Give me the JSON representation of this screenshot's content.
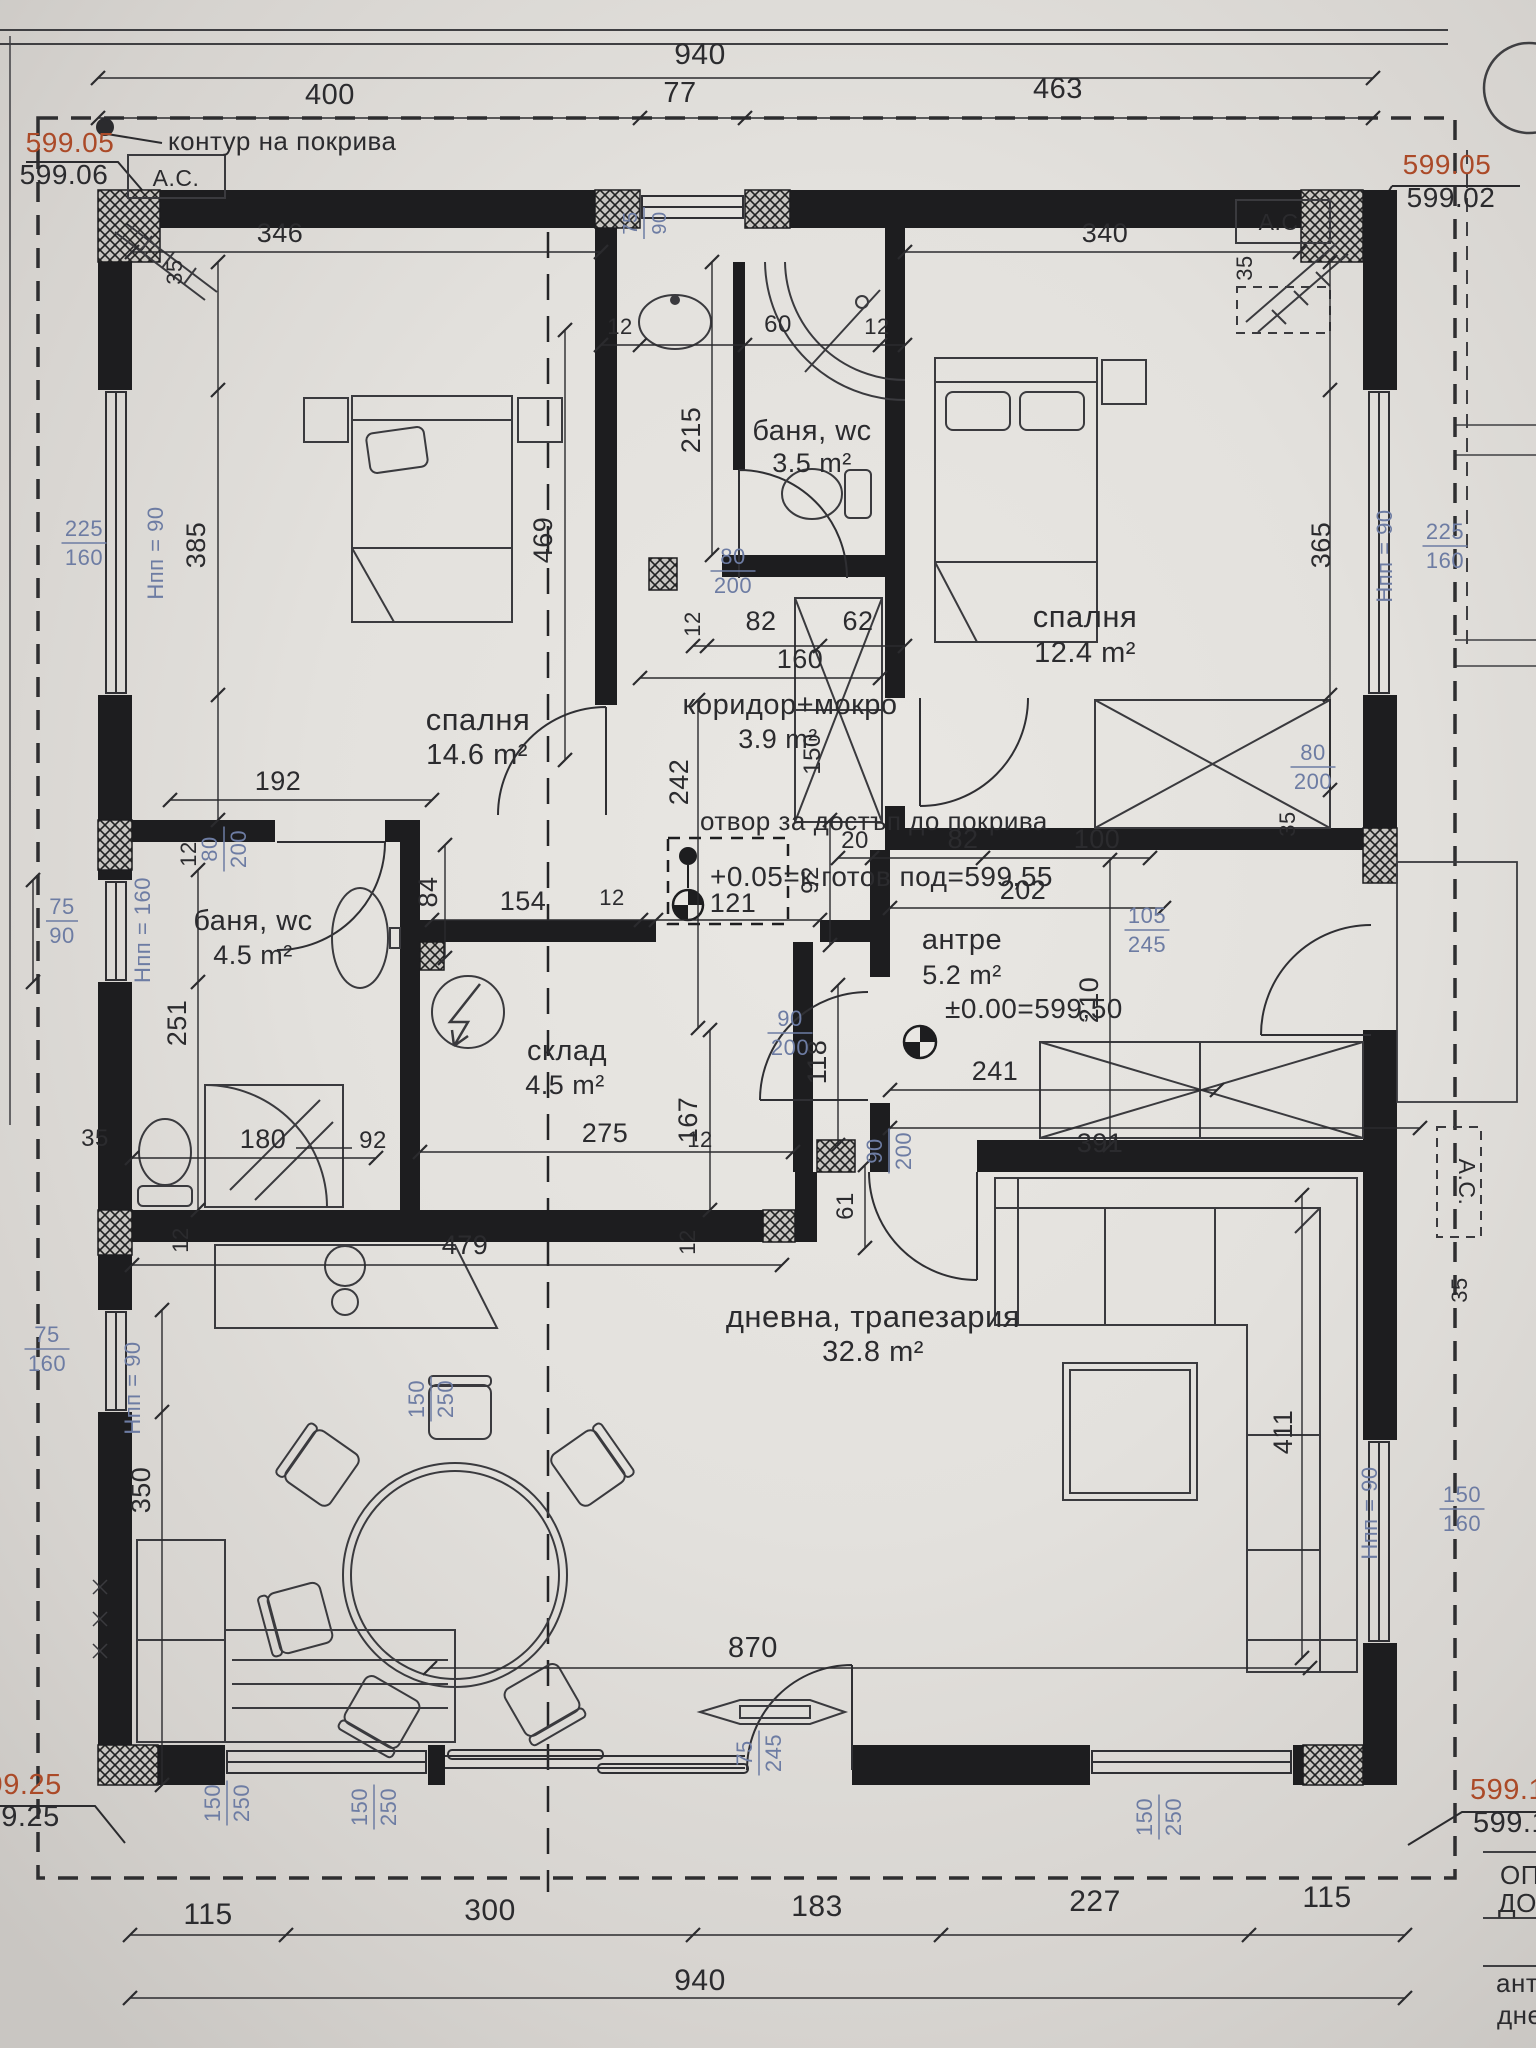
{
  "document": {
    "kind": "architectural floor plan",
    "language": "bulgarian"
  },
  "palette": {
    "ink": "#2b2b2e",
    "wall": "#1d1d1f",
    "blue": "#6d7ca3",
    "red": "#ab4a28",
    "paper": "#e6e4e0"
  },
  "labels": [
    {
      "n": "room-bedroom1-name",
      "t": "спалня",
      "x": 478,
      "y": 730,
      "s": 31
    },
    {
      "n": "room-bedroom1-area",
      "t": "14.6 m²",
      "x": 477,
      "y": 764,
      "s": 29
    },
    {
      "n": "room-bath1-name",
      "t": "баня, wc",
      "x": 812,
      "y": 440,
      "s": 29
    },
    {
      "n": "room-bath1-area",
      "t": "3.5 m²",
      "x": 812,
      "y": 472,
      "s": 27
    },
    {
      "n": "room-bedroom2-name",
      "t": "спалня",
      "x": 1085,
      "y": 627,
      "s": 31
    },
    {
      "n": "room-bedroom2-area",
      "t": "12.4 m²",
      "x": 1085,
      "y": 662,
      "s": 29
    },
    {
      "n": "room-corridor-name",
      "t": "коридор+мокро",
      "x": 790,
      "y": 714,
      "s": 29
    },
    {
      "n": "room-corridor-area",
      "t": "3.9 m²",
      "x": 778,
      "y": 748,
      "s": 27
    },
    {
      "n": "room-bath2-name",
      "t": "баня, wc",
      "x": 253,
      "y": 930,
      "s": 29
    },
    {
      "n": "room-bath2-area",
      "t": "4.5 m²",
      "x": 253,
      "y": 964,
      "s": 27
    },
    {
      "n": "room-storage-name",
      "t": "склад",
      "x": 567,
      "y": 1060,
      "s": 29
    },
    {
      "n": "room-storage-area",
      "t": "4.5 m²",
      "x": 565,
      "y": 1094,
      "s": 27
    },
    {
      "n": "room-antre-name",
      "t": "антре",
      "x": 962,
      "y": 949,
      "s": 29
    },
    {
      "n": "room-antre-area",
      "t": "5.2 m²",
      "x": 962,
      "y": 984,
      "s": 27
    },
    {
      "n": "room-living-name",
      "t": "дневна, трапезария",
      "x": 873,
      "y": 1327,
      "s": 31
    },
    {
      "n": "room-living-area",
      "t": "32.8 m²",
      "x": 873,
      "y": 1361,
      "s": 29
    },
    {
      "n": "roof-contour-label",
      "t": "контур на покрива",
      "x": 168,
      "y": 150,
      "s": 26,
      "a": "start"
    },
    {
      "n": "roof-access-label",
      "t": "отвор за достъп до покрива",
      "x": 700,
      "y": 830,
      "s": 26,
      "a": "start"
    },
    {
      "n": "finish-floor-label",
      "t": "+0.05=к.готов под=599,55",
      "x": 710,
      "y": 886,
      "s": 28,
      "a": "start"
    },
    {
      "n": "zero-level-label",
      "t": "±0.00=599,50",
      "x": 945,
      "y": 1018,
      "s": 28,
      "a": "start"
    },
    {
      "n": "ac-label-top-left",
      "t": "A.C.",
      "x": 176,
      "y": 186,
      "s": 23
    },
    {
      "n": "ac-label-top-right",
      "t": "A.C.",
      "x": 1282,
      "y": 230,
      "s": 23
    },
    {
      "n": "ac-label-right",
      "t": "A.C.",
      "x": 1459,
      "y": 1182,
      "s": 23,
      "r": 90
    },
    {
      "n": "elevation-tl-roof",
      "t": "599.05",
      "x": 70,
      "y": 152,
      "s": 28,
      "c": "r"
    },
    {
      "n": "elevation-tl-floor",
      "t": "599.06",
      "x": 64,
      "y": 184,
      "s": 28
    },
    {
      "n": "elevation-tr-roof",
      "t": "599.05",
      "x": 1447,
      "y": 174,
      "s": 28,
      "c": "r"
    },
    {
      "n": "elevation-tr-floor",
      "t": "599.02",
      "x": 1451,
      "y": 207,
      "s": 28
    },
    {
      "n": "elevation-bl-roof",
      "t": "599.25",
      "x": -30,
      "y": 1794,
      "s": 29,
      "a": "start",
      "c": "r"
    },
    {
      "n": "elevation-bl-floor",
      "t": "599.25",
      "x": -32,
      "y": 1826,
      "s": 29,
      "a": "start"
    },
    {
      "n": "elevation-br-roof",
      "t": "599.13",
      "x": 1470,
      "y": 1799,
      "s": 29,
      "a": "start",
      "c": "r"
    },
    {
      "n": "elevation-br-floor",
      "t": "599.13",
      "x": 1473,
      "y": 1832,
      "s": 29,
      "a": "start"
    },
    {
      "n": "dim-top-total",
      "t": "940",
      "x": 700,
      "y": 64,
      "s": 30
    },
    {
      "n": "dim-top-1",
      "t": "400",
      "x": 330,
      "y": 104,
      "s": 29
    },
    {
      "n": "dim-top-2",
      "t": "77",
      "x": 680,
      "y": 102,
      "s": 29
    },
    {
      "n": "dim-top-3",
      "t": "463",
      "x": 1058,
      "y": 98,
      "s": 29
    },
    {
      "n": "dim-bottom-1",
      "t": "115",
      "x": 208,
      "y": 1924,
      "s": 30
    },
    {
      "n": "dim-bottom-2",
      "t": "300",
      "x": 490,
      "y": 1920,
      "s": 30
    },
    {
      "n": "dim-bottom-3",
      "t": "183",
      "x": 817,
      "y": 1916,
      "s": 30
    },
    {
      "n": "dim-bottom-4",
      "t": "227",
      "x": 1095,
      "y": 1911,
      "s": 30
    },
    {
      "n": "dim-bottom-5",
      "t": "115",
      "x": 1327,
      "y": 1907,
      "s": 30
    },
    {
      "n": "dim-bottom-total",
      "t": "940",
      "x": 700,
      "y": 1990,
      "s": 30
    },
    {
      "n": "dim-346",
      "t": "346",
      "x": 280,
      "y": 242,
      "s": 27
    },
    {
      "n": "dim-12a",
      "t": "12",
      "x": 620,
      "y": 334,
      "s": 22
    },
    {
      "n": "dim-60",
      "t": "60",
      "x": 778,
      "y": 332,
      "s": 24
    },
    {
      "n": "dim-12b",
      "t": "12",
      "x": 877,
      "y": 334,
      "s": 22
    },
    {
      "n": "dim-340",
      "t": "340",
      "x": 1105,
      "y": 242,
      "s": 27
    },
    {
      "n": "dim-215",
      "t": "215",
      "x": 700,
      "y": 430,
      "s": 27,
      "r": -90
    },
    {
      "n": "dim-385",
      "t": "385",
      "x": 205,
      "y": 545,
      "s": 27,
      "r": -90
    },
    {
      "n": "dim-365",
      "t": "365",
      "x": 1330,
      "y": 545,
      "s": 27,
      "r": -90
    },
    {
      "n": "dim-469",
      "t": "469",
      "x": 552,
      "y": 540,
      "s": 27,
      "r": -90
    },
    {
      "n": "dim-12c",
      "t": "12",
      "x": 700,
      "y": 624,
      "s": 22,
      "r": -90
    },
    {
      "n": "dim-82a",
      "t": "82",
      "x": 761,
      "y": 630,
      "s": 27
    },
    {
      "n": "dim-62",
      "t": "62",
      "x": 858,
      "y": 630,
      "s": 27
    },
    {
      "n": "dim-160",
      "t": "160",
      "x": 800,
      "y": 668,
      "s": 27
    },
    {
      "n": "dim-242",
      "t": "242",
      "x": 688,
      "y": 782,
      "s": 27,
      "r": -90
    },
    {
      "n": "dim-150h",
      "t": "150",
      "x": 820,
      "y": 754,
      "s": 24,
      "r": -90
    },
    {
      "n": "dim-192",
      "t": "192",
      "x": 278,
      "y": 790,
      "s": 27
    },
    {
      "n": "dim-12d",
      "t": "12",
      "x": 196,
      "y": 854,
      "s": 22,
      "r": -90
    },
    {
      "n": "dim-84",
      "t": "84",
      "x": 437,
      "y": 892,
      "s": 27,
      "r": -90
    },
    {
      "n": "dim-154",
      "t": "154",
      "x": 523,
      "y": 910,
      "s": 27
    },
    {
      "n": "dim-12e",
      "t": "12",
      "x": 612,
      "y": 905,
      "s": 22
    },
    {
      "n": "dim-121",
      "t": "121",
      "x": 733,
      "y": 912,
      "s": 27
    },
    {
      "n": "dim-202",
      "t": "202",
      "x": 1023,
      "y": 899,
      "s": 27
    },
    {
      "n": "dim-92a",
      "t": "92",
      "x": 818,
      "y": 880,
      "s": 24,
      "r": -90
    },
    {
      "n": "dim-20",
      "t": "20",
      "x": 855,
      "y": 848,
      "s": 24
    },
    {
      "n": "dim-82b",
      "t": "82",
      "x": 963,
      "y": 848,
      "s": 27
    },
    {
      "n": "dim-100",
      "t": "100",
      "x": 1097,
      "y": 848,
      "s": 27
    },
    {
      "n": "dim-210",
      "t": "210",
      "x": 1098,
      "y": 1000,
      "s": 27,
      "r": -90
    },
    {
      "n": "dim-241",
      "t": "241",
      "x": 995,
      "y": 1080,
      "s": 27
    },
    {
      "n": "dim-391",
      "t": "391",
      "x": 1100,
      "y": 1152,
      "s": 27
    },
    {
      "n": "dim-118",
      "t": "118",
      "x": 826,
      "y": 1062,
      "s": 27,
      "r": -90
    },
    {
      "n": "dim-167",
      "t": "167",
      "x": 697,
      "y": 1120,
      "s": 27,
      "r": -90
    },
    {
      "n": "dim-61",
      "t": "61",
      "x": 853,
      "y": 1206,
      "s": 24,
      "r": -90
    },
    {
      "n": "dim-12f",
      "t": "12",
      "x": 700,
      "y": 1147,
      "s": 22
    },
    {
      "n": "dim-251",
      "t": "251",
      "x": 186,
      "y": 1023,
      "s": 27,
      "r": -90
    },
    {
      "n": "dim-35a",
      "t": "35",
      "x": 95,
      "y": 1146,
      "s": 24
    },
    {
      "n": "dim-180",
      "t": "180",
      "x": 263,
      "y": 1148,
      "s": 27
    },
    {
      "n": "dim-92b",
      "t": "92",
      "x": 373,
      "y": 1148,
      "s": 24
    },
    {
      "n": "dim-275",
      "t": "275",
      "x": 605,
      "y": 1142,
      "s": 27
    },
    {
      "n": "dim-479",
      "t": "479",
      "x": 465,
      "y": 1254,
      "s": 27
    },
    {
      "n": "dim-12g",
      "t": "12",
      "x": 188,
      "y": 1240,
      "s": 22,
      "r": -90
    },
    {
      "n": "dim-12h",
      "t": "12",
      "x": 695,
      "y": 1242,
      "s": 22,
      "r": -90
    },
    {
      "n": "dim-870",
      "t": "870",
      "x": 753,
      "y": 1657,
      "s": 29
    },
    {
      "n": "dim-350",
      "t": "350",
      "x": 150,
      "y": 1490,
      "s": 27,
      "r": -90
    },
    {
      "n": "dim-411",
      "t": "411",
      "x": 1292,
      "y": 1432,
      "s": 27,
      "r": -90
    },
    {
      "n": "dim-35b",
      "t": "35",
      "x": 182,
      "y": 272,
      "s": 22,
      "r": -90
    },
    {
      "n": "dim-35c",
      "t": "35",
      "x": 1252,
      "y": 268,
      "s": 22,
      "r": -90
    },
    {
      "n": "dim-35d",
      "t": "35",
      "x": 1295,
      "y": 824,
      "s": 22,
      "r": -90
    },
    {
      "n": "dim-35e",
      "t": "35",
      "x": 1467,
      "y": 1290,
      "s": 22,
      "r": -90
    },
    {
      "n": "window-size-bedroom1",
      "t": "225/160",
      "x": 84,
      "y": 540,
      "s": 22,
      "c": "b",
      "f": 1
    },
    {
      "n": "window-size-bath2",
      "t": "75/90",
      "x": 62,
      "y": 918,
      "s": 22,
      "c": "b",
      "f": 1
    },
    {
      "n": "window-size-kitchen",
      "t": "75/160",
      "x": 47,
      "y": 1346,
      "s": 22,
      "c": "b",
      "f": 1
    },
    {
      "n": "window-size-bottom-1",
      "t": "150/250",
      "x": 233,
      "y": 1794,
      "s": 22,
      "c": "b",
      "f": 1,
      "r": -90
    },
    {
      "n": "window-size-bottom-2",
      "t": "150/250",
      "x": 380,
      "y": 1798,
      "s": 22,
      "c": "b",
      "f": 1,
      "r": -90
    },
    {
      "n": "window-size-bottom-3",
      "t": "150/250",
      "x": 437,
      "y": 1390,
      "s": 22,
      "c": "b",
      "f": 1,
      "r": -90
    },
    {
      "n": "window-size-bottom-4",
      "t": "150/250",
      "x": 1165,
      "y": 1808,
      "s": 22,
      "c": "b",
      "f": 1,
      "r": -90
    },
    {
      "n": "window-size-living",
      "t": "150/160",
      "x": 1462,
      "y": 1506,
      "s": 22,
      "c": "b",
      "f": 1
    },
    {
      "n": "window-size-bedroom2",
      "t": "225/160",
      "x": 1445,
      "y": 543,
      "s": 22,
      "c": "b",
      "f": 1
    },
    {
      "n": "door-size-bedroom1",
      "t": "80/200",
      "x": 733,
      "y": 568,
      "s": 22,
      "c": "b",
      "f": 1
    },
    {
      "n": "door-size-bath2",
      "t": "80/200",
      "x": 230,
      "y": 840,
      "s": 22,
      "c": "b",
      "f": 1,
      "r": -90
    },
    {
      "n": "door-size-bedroom2",
      "t": "80/200",
      "x": 1313,
      "y": 764,
      "s": 22,
      "c": "b",
      "f": 1
    },
    {
      "n": "door-size-antre-corridor",
      "t": "90/200",
      "x": 790,
      "y": 1030,
      "s": 22,
      "c": "b",
      "f": 1
    },
    {
      "n": "door-size-antre-living",
      "t": "90/200",
      "x": 895,
      "y": 1142,
      "s": 22,
      "c": "b",
      "f": 1,
      "r": -90
    },
    {
      "n": "door-size-entrance",
      "t": "105/245",
      "x": 1147,
      "y": 927,
      "s": 22,
      "c": "b",
      "f": 1
    },
    {
      "n": "door-size-terrace",
      "t": "75/245",
      "x": 765,
      "y": 1744,
      "s": 22,
      "c": "b",
      "f": 1,
      "r": -90
    },
    {
      "n": "window-size-bath1",
      "t": "75/90",
      "x": 650,
      "y": 214,
      "s": 20,
      "c": "b",
      "f": 1,
      "r": -90
    },
    {
      "n": "parapet-bedroom1",
      "t": "Hпп = 90",
      "x": 163,
      "y": 553,
      "s": 22,
      "c": "b",
      "r": -90
    },
    {
      "n": "parapet-bath2",
      "t": "Hпп = 160",
      "x": 150,
      "y": 930,
      "s": 22,
      "c": "b",
      "r": -90
    },
    {
      "n": "parapet-kitchen",
      "t": "Hпп = 90",
      "x": 140,
      "y": 1388,
      "s": 22,
      "c": "b",
      "r": -90
    },
    {
      "n": "parapet-bedroom2",
      "t": "Hпп = 90",
      "x": 1392,
      "y": 556,
      "s": 22,
      "c": "b",
      "r": -90
    },
    {
      "n": "parapet-living",
      "t": "Hпп = 90",
      "x": 1377,
      "y": 1513,
      "s": 22,
      "c": "b",
      "r": -90
    },
    {
      "n": "titleblock-row-1",
      "t": "ОП",
      "x": 1500,
      "y": 1884,
      "s": 26,
      "a": "start"
    },
    {
      "n": "titleblock-row-2",
      "t": "ДО",
      "x": 1498,
      "y": 1912,
      "s": 26,
      "a": "start"
    },
    {
      "n": "titleblock-row-3",
      "t": "ант",
      "x": 1496,
      "y": 1992,
      "s": 26,
      "a": "start"
    },
    {
      "n": "titleblock-row-4",
      "t": "дне",
      "x": 1497,
      "y": 2024,
      "s": 26,
      "a": "start"
    }
  ]
}
